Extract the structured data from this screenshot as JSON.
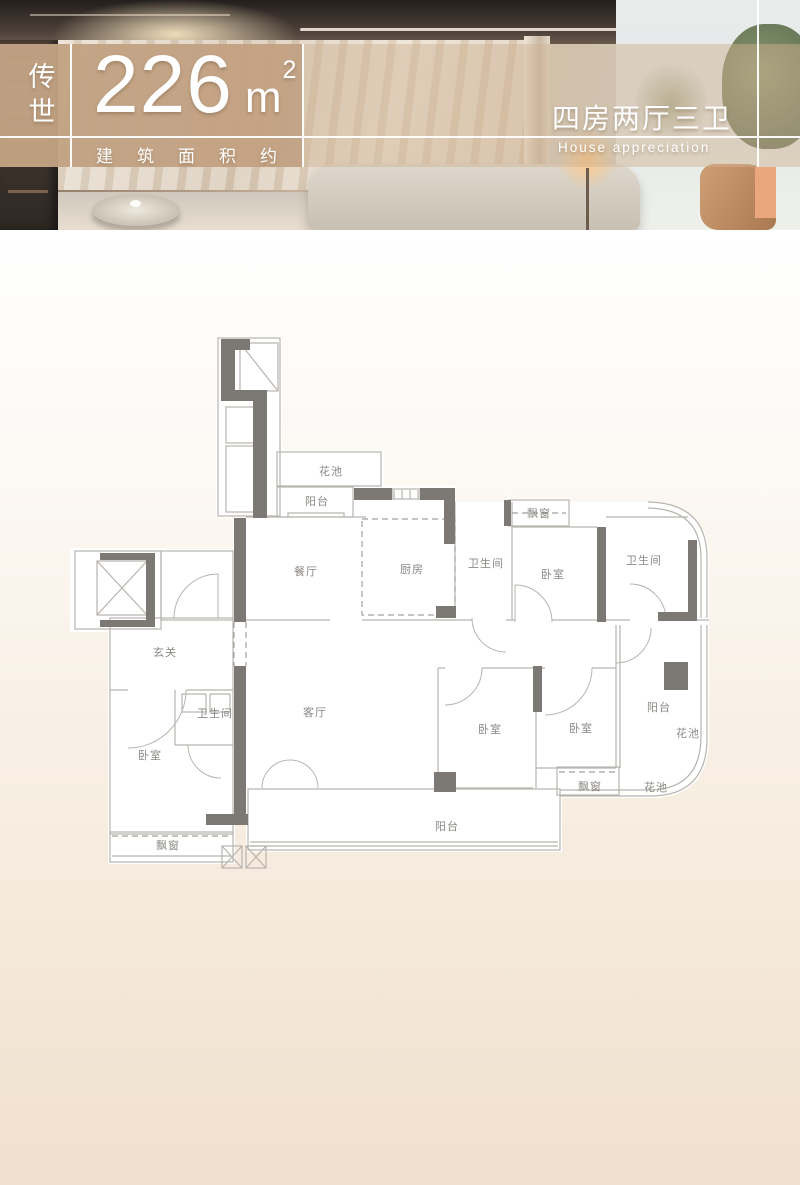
{
  "header": {
    "series_label": "传世",
    "area_number": "226",
    "area_unit_base": "m",
    "area_unit_exp": "2",
    "area_caption": "建筑面积约",
    "layout_title": "四房两厅三卫",
    "layout_subtitle": "House appreciation"
  },
  "plan": {
    "labels": [
      "花池",
      "阳台",
      "餐厅",
      "厨房",
      "卫生间",
      "飘窗",
      "卧室",
      "卫生间",
      "玄关",
      "卫生间",
      "卧室",
      "飘窗",
      "客厅",
      "卧室",
      "卧室",
      "阳台",
      "花池",
      "飘窗",
      "花池",
      "阳台"
    ]
  },
  "colors": {
    "accent_tan": "#c2a183",
    "accent_orange": "#eba67c",
    "wall_gray": "#7c7975",
    "line_gray": "#b8b4af",
    "canvas_bottom": "#f0e0cd"
  }
}
